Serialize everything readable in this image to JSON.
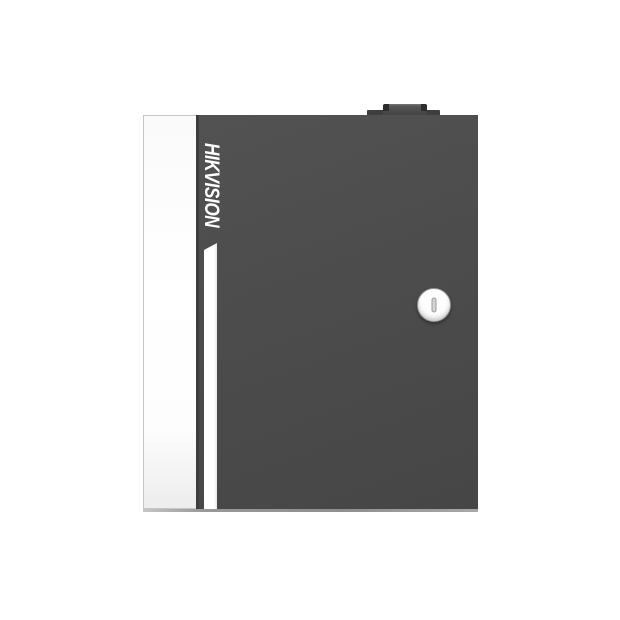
{
  "photo": {
    "description": "Product photo of a dark gray wall-mount lockable metal enclosure with vertical brand logotype, white left edge panel, white accent stripe, round cam lock and top hinge block, on a plain white background"
  },
  "device": {
    "brand": "HIKVISION"
  },
  "icons": {
    "keyhole": "keyhole-icon",
    "hinge": "hinge-block"
  },
  "colors": {
    "background": "#ffffff",
    "door": "#4c4c4c",
    "door-edge": "#3d3d3d",
    "panel": "#ffffff",
    "panel-border": "#c6c6c6",
    "stripe": "#ffffff",
    "brand-text": "#ffffff",
    "lock-face": "#fdfdfd",
    "lock-rim": "#bfbfbf",
    "keyhole": "#d4d4d4",
    "hinge": "#3e3e3e",
    "bevel": "#8f8f8f"
  }
}
